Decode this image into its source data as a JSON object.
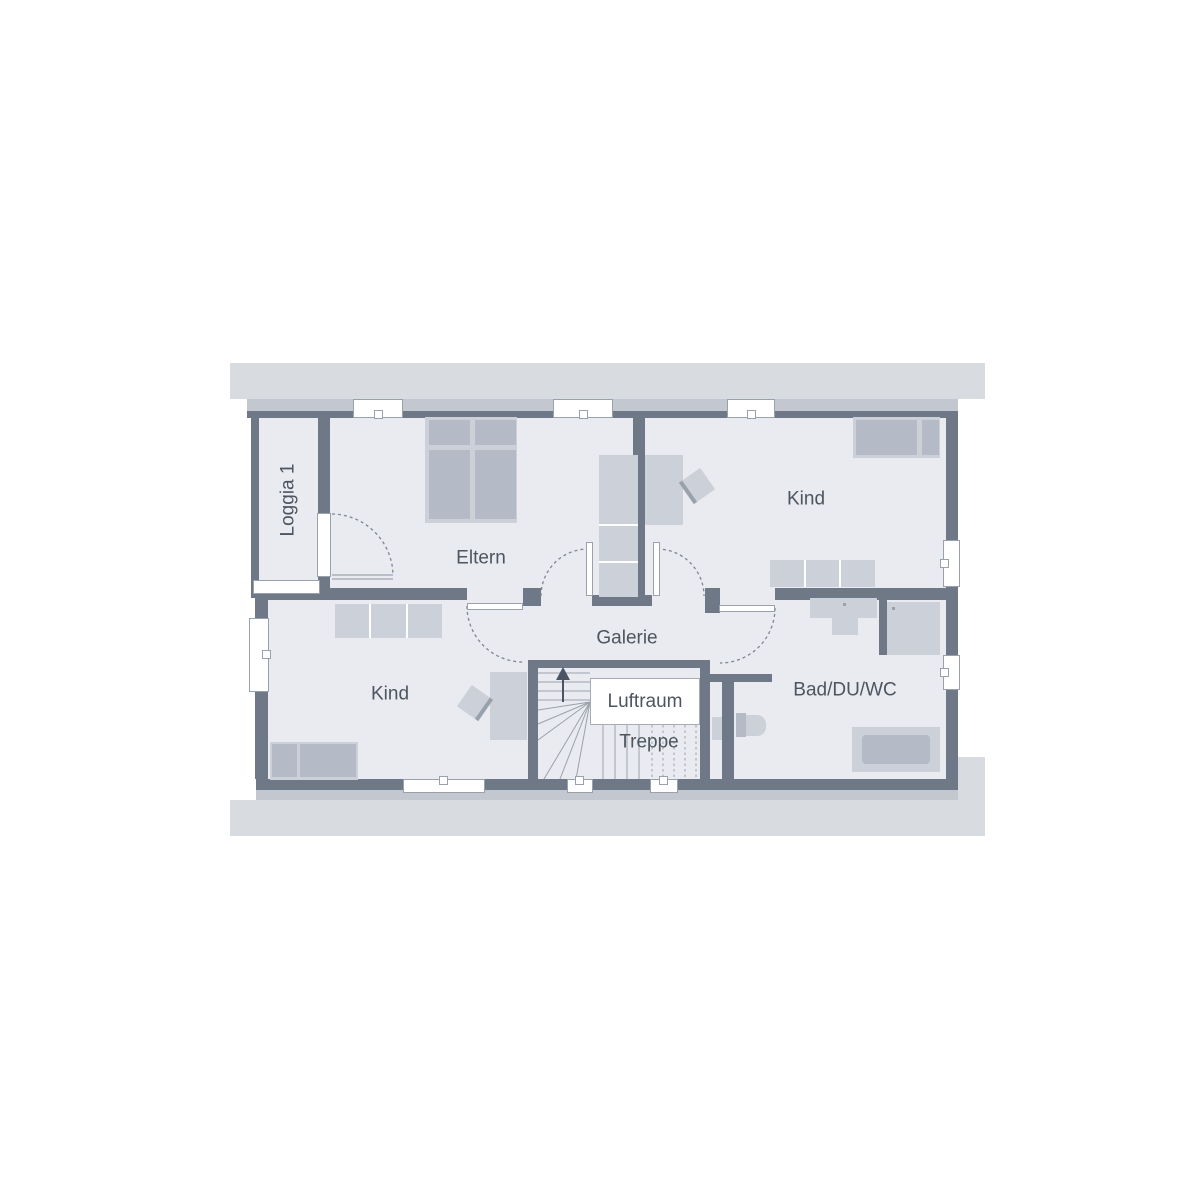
{
  "document_type": "floor-plan",
  "floor": {
    "labels": {
      "loggia": "Loggia 1",
      "eltern": "Eltern",
      "kind_top": "Kind",
      "kind_bottom": "Kind",
      "galerie": "Galerie",
      "luftraum": "Luftraum",
      "treppe": "Treppe",
      "bad": "Bad/DU/WC"
    },
    "rooms": [
      {
        "id": "loggia",
        "label": "Loggia 1"
      },
      {
        "id": "eltern",
        "label": "Eltern"
      },
      {
        "id": "kind_top",
        "label": "Kind"
      },
      {
        "id": "kind_bottom",
        "label": "Kind"
      },
      {
        "id": "galerie",
        "label": "Galerie"
      },
      {
        "id": "bad",
        "label": "Bad/DU/WC"
      }
    ],
    "stair": {
      "void_label": "Luftraum",
      "stair_label": "Treppe",
      "direction": "up"
    }
  },
  "palette": {
    "wall": "#6e7886",
    "floor": "#e9ebf0",
    "roof_band": "#d8dbe0",
    "sill_band": "#c2c7d0",
    "furniture_light": "#ccd1d9",
    "furniture_mid": "#b4bac6",
    "label_text": "#4d5560",
    "line": "#99a1ad",
    "dash": "#7d8692",
    "arrow": "#4a5462"
  }
}
